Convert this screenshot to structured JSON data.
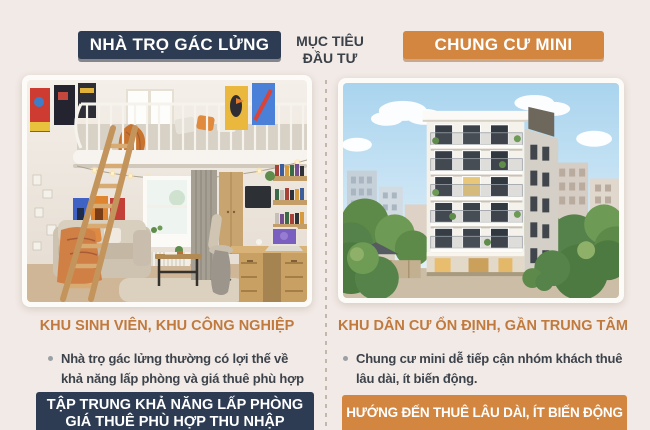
{
  "theme": {
    "bg": "#f2eae6",
    "navy": "#2e3c53",
    "navy_shadow": "rgba(24,34,50,0.5)",
    "orange": "#d2863f",
    "orange_shadow": "rgba(150,89,36,0.45)",
    "heading": "#c07a3e",
    "text": "#3d434b",
    "dash": "#c3b7ac",
    "frame": "#fdfbf8",
    "bullet_dot": "#9aa0a4"
  },
  "header": {
    "left_badge": "NHÀ TRỌ GÁC LỬNG",
    "objective": {
      "line1": "MỤC TIÊU",
      "line2": "ĐẦU TƯ"
    },
    "right_badge": "CHUNG CƯ MINI"
  },
  "left": {
    "photo": "loft-room-interior",
    "heading": "KHU SINH VIÊN, KHU CÔNG NGHIỆP",
    "bullet": "Nhà trọ gác lửng thường có lợi thế về khả năng lấp phòng và giá thuê phù hợp",
    "footer_line1": "TẬP TRUNG KHẢ NĂNG LẤP PHÒNG",
    "footer_line2": "GIÁ THUÊ PHÙ HỢP THU NHẬP"
  },
  "right": {
    "photo": "mini-apartment-building",
    "heading": "KHU DÂN CƯ ỔN ĐỊNH, GẦN TRUNG TÂM",
    "bullet": "Chung cư mini dễ tiếp cận nhóm khách thuê lâu dài, ít biến động.",
    "footer": "HƯỚNG ĐẾN THUÊ LÂU DÀI, ÍT BIẾN ĐỘNG"
  }
}
